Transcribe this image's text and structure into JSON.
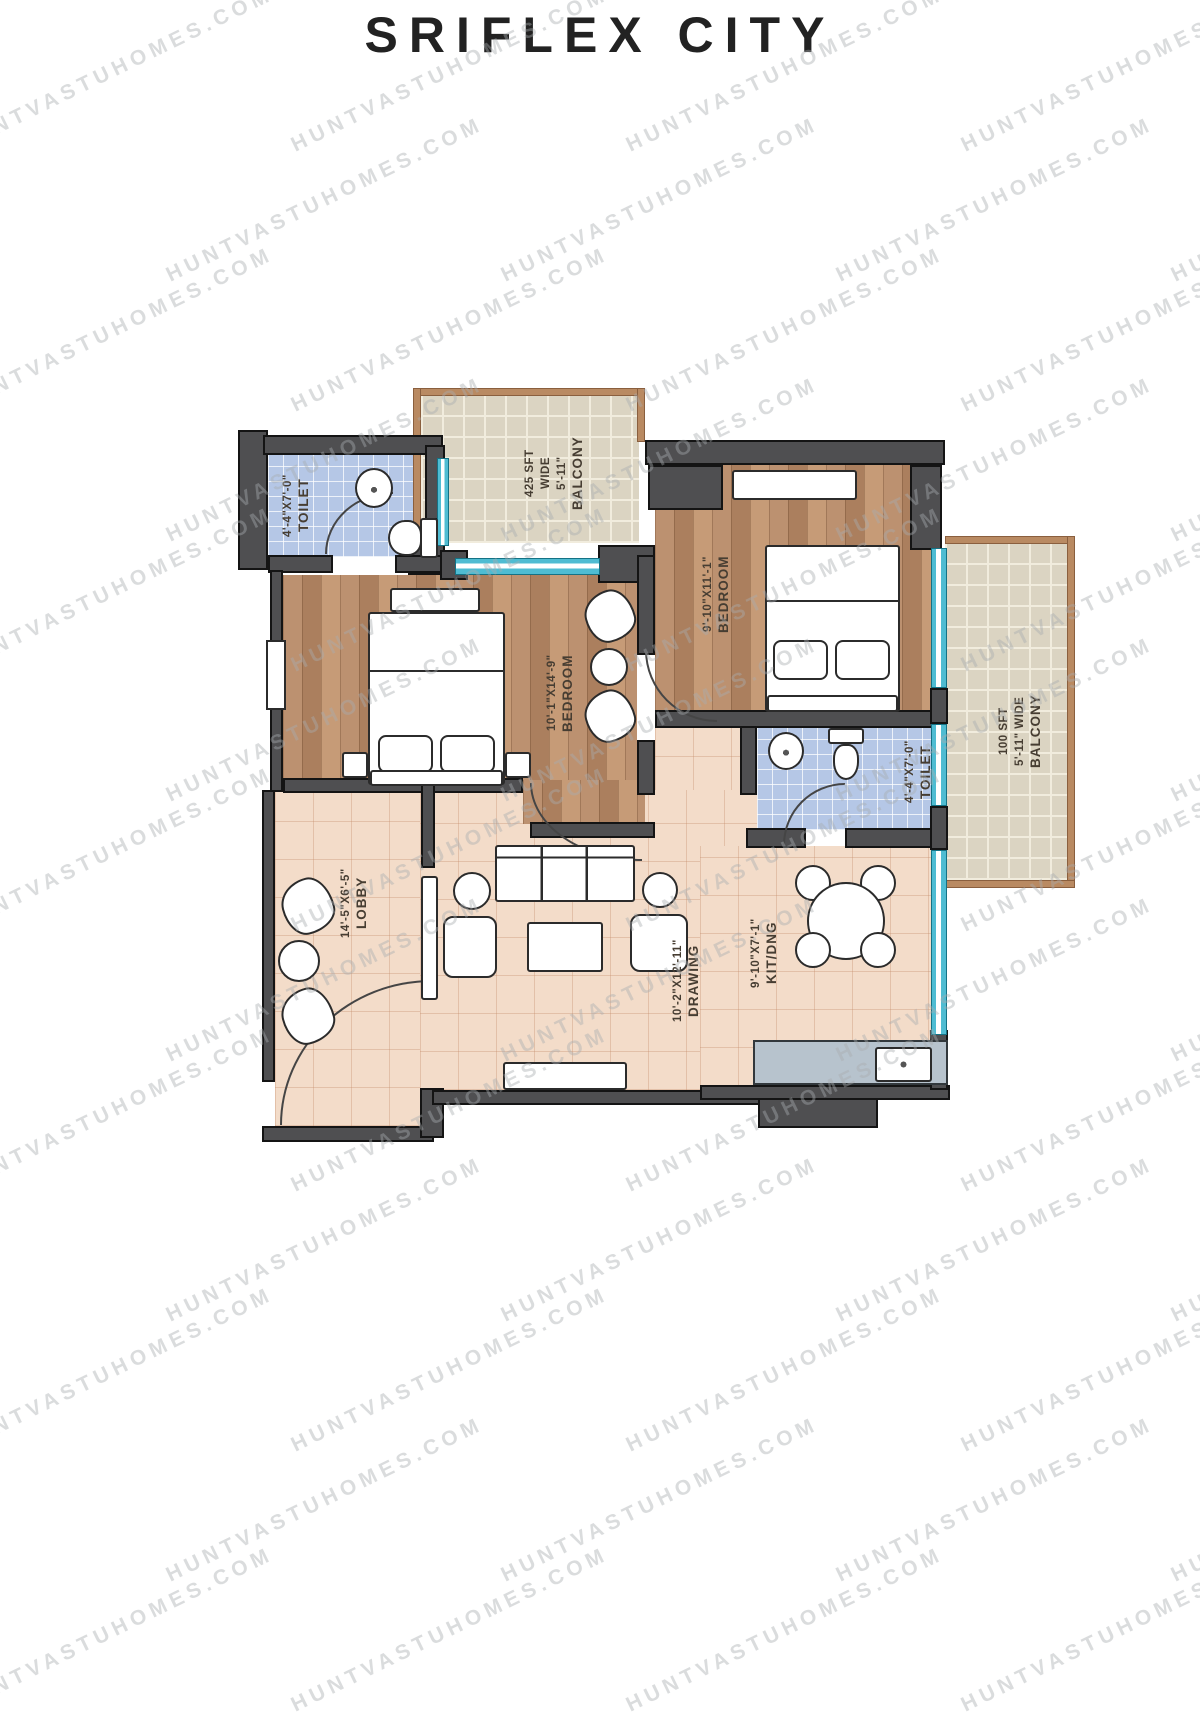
{
  "title": "SRIFLEX CITY",
  "watermark": {
    "text": "HUNTVASTUHOMES.COM"
  },
  "plan": {
    "orientation": "rotated-180",
    "rooms": {
      "toilet1": {
        "name": "TOILET",
        "dims": "4'-4\"X7'-0\""
      },
      "toilet2": {
        "name": "TOILET",
        "dims": "4'-4\"X7'-0\""
      },
      "bedroom1": {
        "name": "BEDROOM",
        "dims": "10'-1\"X14'-9\""
      },
      "bedroom2": {
        "name": "BEDROOM",
        "dims": "9'-10\"X11'-1\""
      },
      "drawing": {
        "name": "DRAWING",
        "dims": "10'-2\"X12'-11\""
      },
      "kitchen_dining": {
        "name": "KIT/DNG",
        "dims": "9'-10\"X7'-1\""
      },
      "lobby": {
        "name": "LOBBY",
        "dims": "14'-5\"X6'-5\""
      },
      "balcony_top": {
        "name": "BALCONY",
        "width": "5'-11\"",
        "wide": "WIDE",
        "area": "425 SFT"
      },
      "balcony_right": {
        "name": "BALCONY",
        "width": "5'-11\" WIDE",
        "area": "100 SFT"
      }
    }
  }
}
